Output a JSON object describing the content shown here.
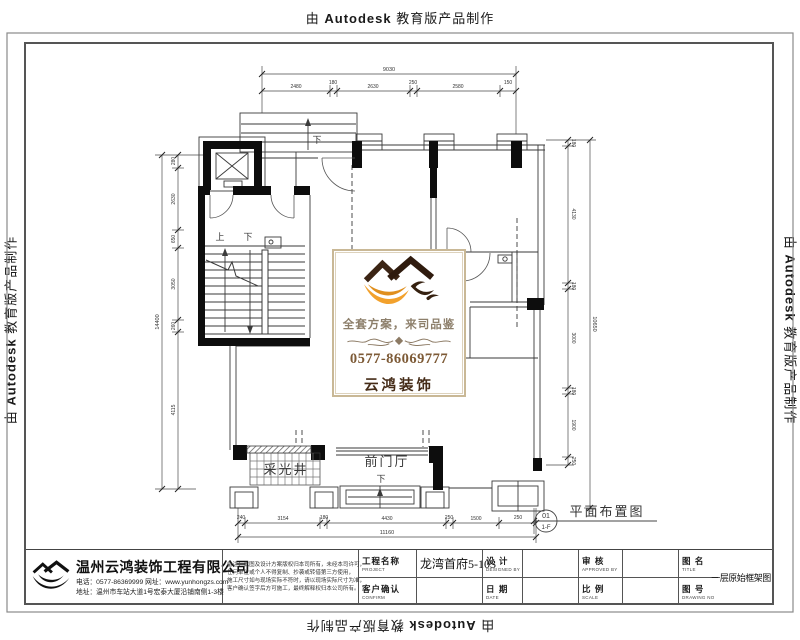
{
  "stamp": {
    "prefix": "由",
    "brand": "Autodesk",
    "suffix": "教育版产品制作"
  },
  "plan": {
    "labels": {
      "balcony_down": "下",
      "stair_up": "上",
      "stair_down": "下",
      "foyer": "前门厅",
      "foyer_down": "下",
      "lightwell": "采光井"
    },
    "dims": {
      "top": {
        "overall": "9030",
        "segments": [
          "2480",
          "180",
          "2630",
          "250",
          "2580",
          "150"
        ]
      },
      "left": {
        "overall": "14400",
        "segments": [
          "280",
          "2630",
          "650",
          "3050",
          "260",
          "4115"
        ]
      },
      "bottom": {
        "overall": "11160",
        "segments": [
          "240",
          "3154",
          "180",
          "4430",
          "250",
          "1500",
          "250"
        ]
      },
      "right": {
        "overall": "10650",
        "segments": [
          "180",
          "4130",
          "180",
          "3000",
          "180",
          "1900",
          "250"
        ]
      }
    },
    "marker": {
      "top": "01",
      "bottom": "1-F",
      "title": "平面布置图"
    }
  },
  "logo_box": {
    "slogan": "全套方案，来司品鉴",
    "phone": "0577-86069777",
    "brand": "云鸿装饰"
  },
  "title_block": {
    "company": {
      "name": "温州云鸿装饰工程有限公司",
      "line1": "电话：0577-86369999 网址：www.yunhongzs.com",
      "line2": "地址：温州市车站大道1号宏泰大厦沿铺南侧1-3楼"
    },
    "notes": [
      "备注：此图及设计方案版权归本司所有，未经本司许可，",
      "任何单位或个人不得复制、抄袭或转借第三方使用，",
      "施工尺寸如与现场实际不符时，请以现场实际尺寸为准，",
      "客户确认签字后方可施工，最终解释权归本公司所有。"
    ],
    "fields": [
      {
        "label": "工程名称",
        "sub": "PROJECT",
        "value": "龙湾首府5-103"
      },
      {
        "label": "客户确认",
        "sub": "CONFIRM",
        "value": ""
      },
      {
        "label": "设  计",
        "sub": "DESIGNED BY",
        "value": ""
      },
      {
        "label": "日  期",
        "sub": "DATE",
        "value": ""
      },
      {
        "label": "审  核",
        "sub": "APPROVED BY",
        "value": ""
      },
      {
        "label": "比  例",
        "sub": "SCALE",
        "value": ""
      },
      {
        "label": "图  名",
        "sub": "TITLE",
        "value": "一层原始框架图"
      },
      {
        "label": "图  号",
        "sub": "DRAWING NO",
        "value": ""
      }
    ]
  }
}
